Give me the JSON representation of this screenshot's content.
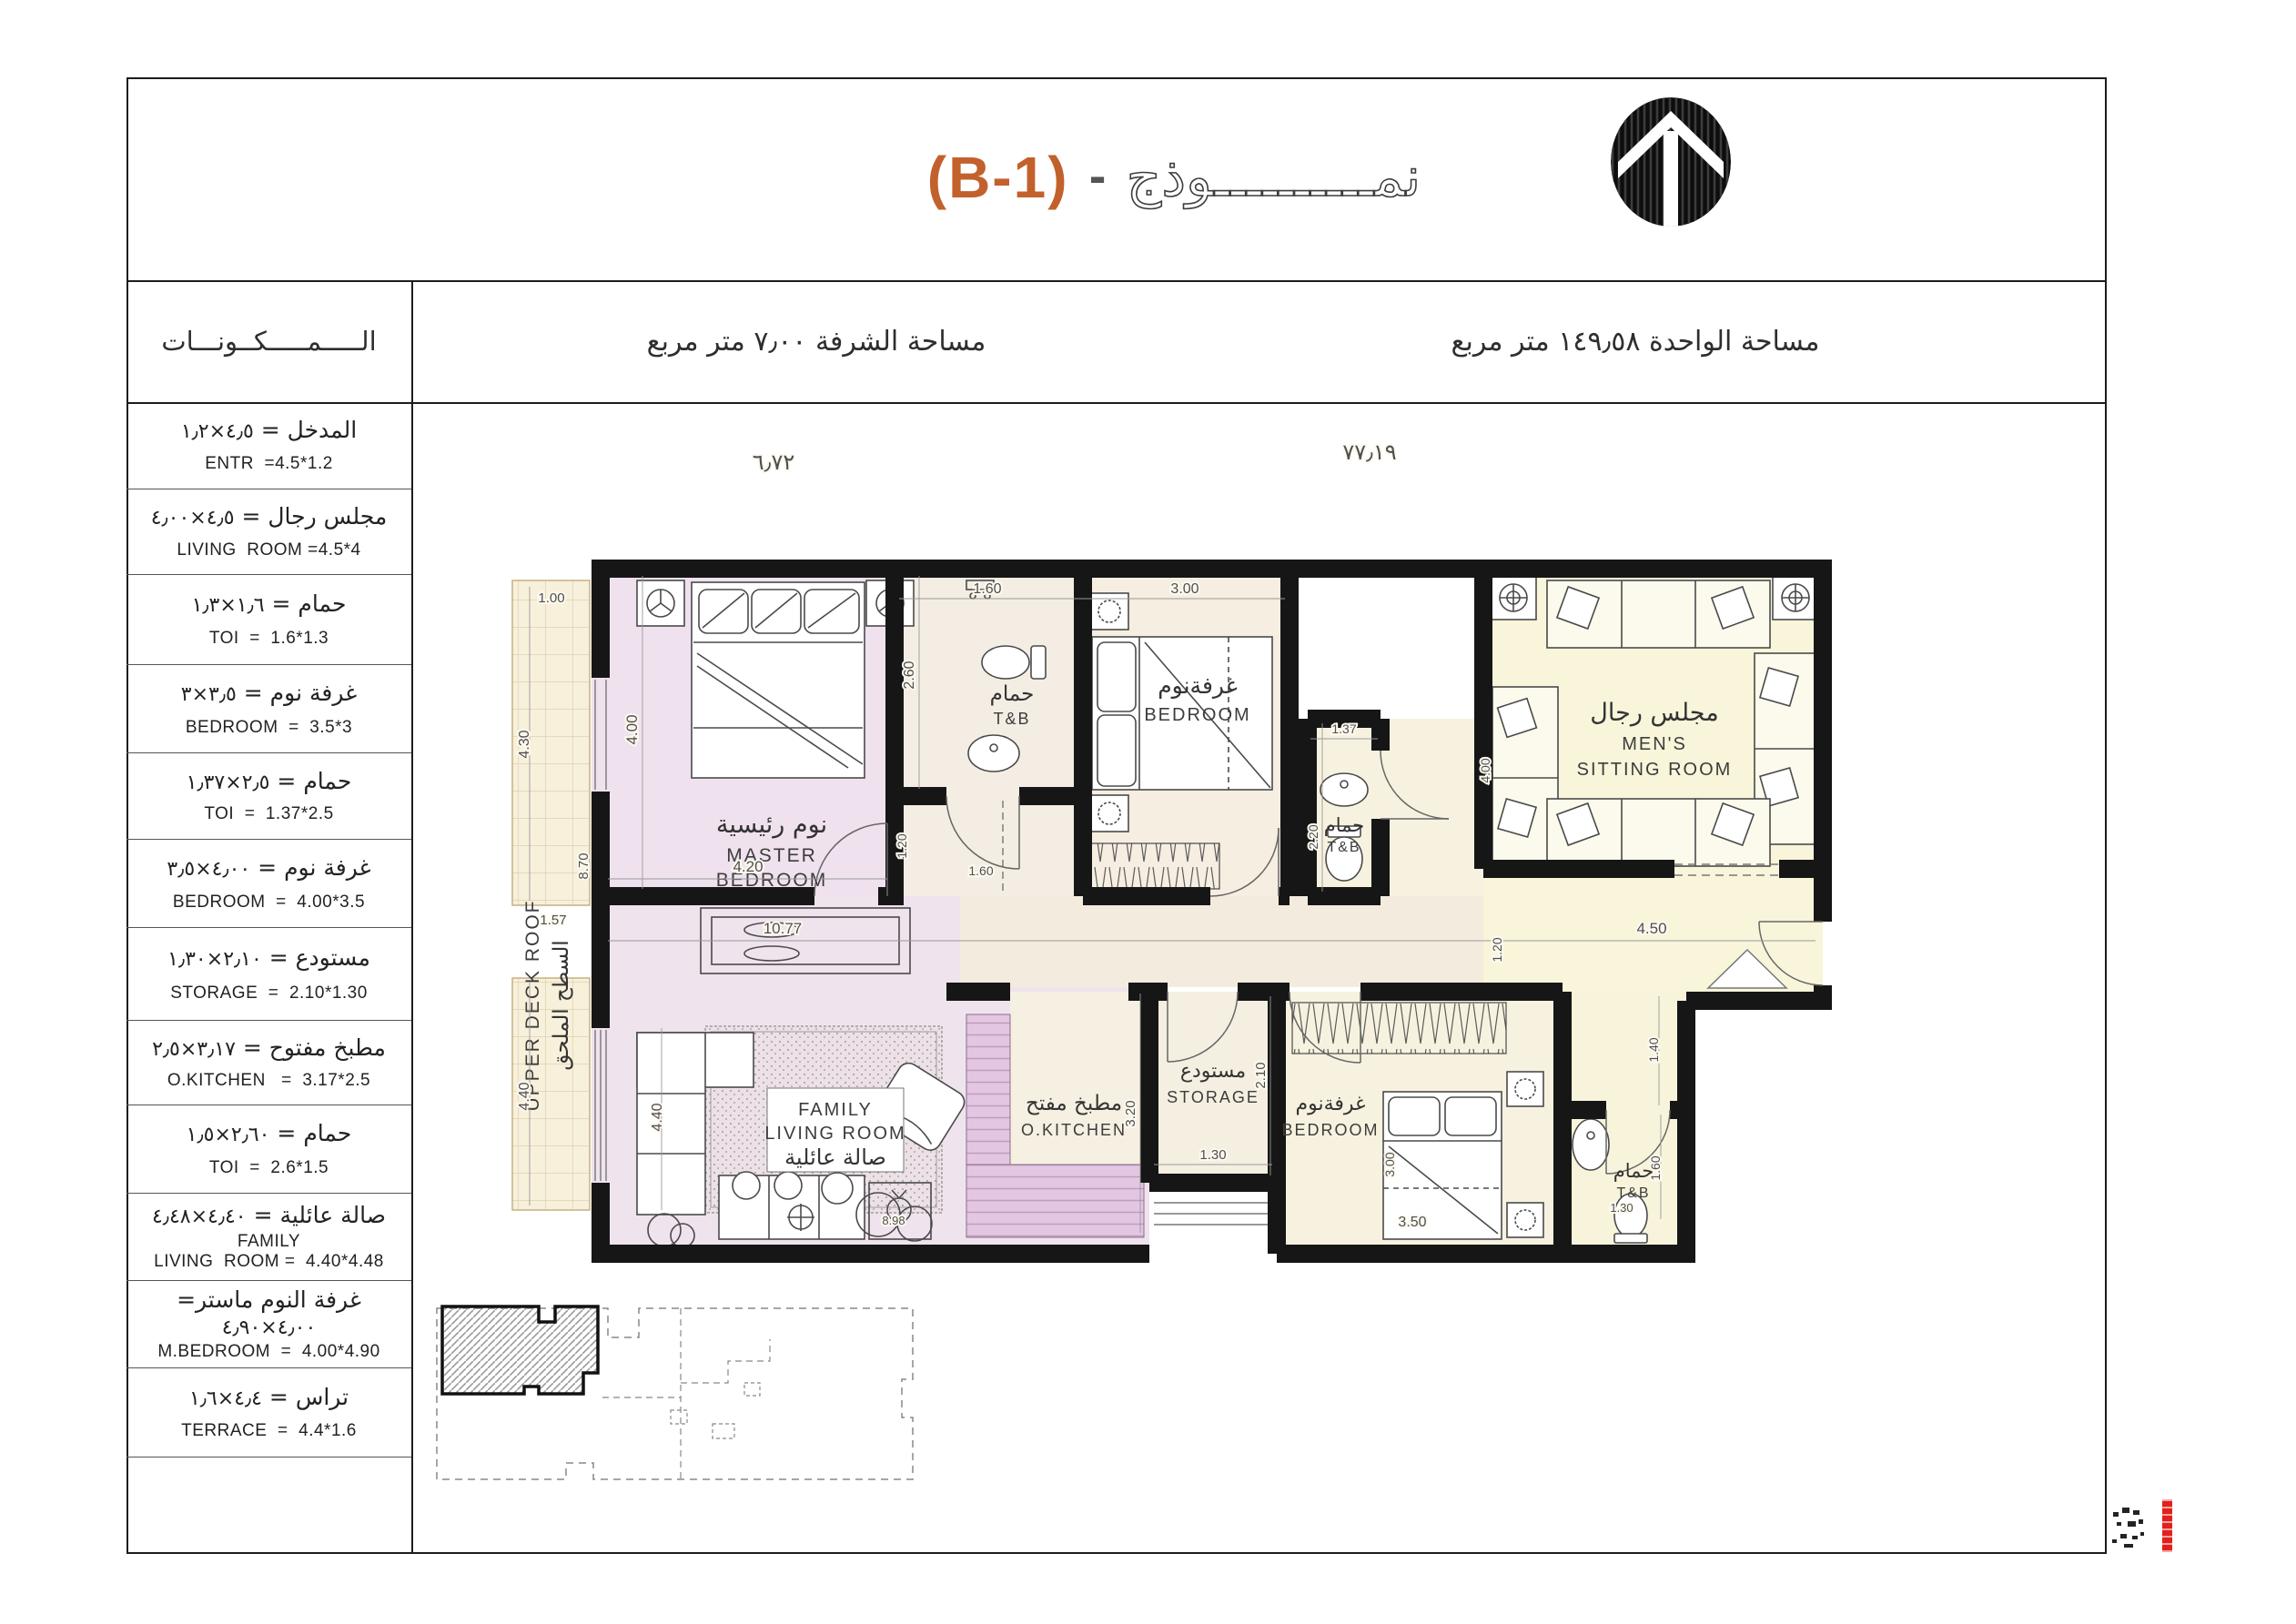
{
  "title": {
    "model_ar": "نمــــــــــوذج",
    "dash": "-",
    "code": "(B-1)"
  },
  "header": {
    "components": "الـــــمـــــكــونـــات",
    "balcony": "مساحة الشرفة  ٧٫٠٠  متر مربع",
    "unit": "مساحة الواحدة  ١٤٩٫٥٨  متر مربع"
  },
  "components": [
    {
      "ar": "المدخل =",
      "dims": "٤٫٥×١٫٢",
      "en": "ENTR  =4.5*1.2"
    },
    {
      "ar": "مجلس رجال  =",
      "dims": "٤٫٥×٤٫٠٠",
      "en": "LIVING  ROOM =4.5*4"
    },
    {
      "ar": "حمام =",
      "dims": "١٫٦×١٫٣",
      "en": "TOI  =  1.6*1.3"
    },
    {
      "ar": "غرفة نوم  =",
      "dims": "٣٫٥×٣",
      "en": "BEDROOM  =  3.5*3"
    },
    {
      "ar": "حمام =",
      "dims": "٢٫٥×١٫٣٧",
      "en": "TOI  =  1.37*2.5"
    },
    {
      "ar": "غرفة نوم =",
      "dims": "٤٫٠٠×٣٫٥",
      "en": "BEDROOM  =  4.00*3.5"
    },
    {
      "ar": "مستودع  =",
      "dims": "٢٫١٠×١٫٣٠",
      "en": "STORAGE  =  2.10*1.30"
    },
    {
      "ar": "مطبخ مفتوح =",
      "dims": "٣٫١٧×٢٫٥",
      "en": "O.KITCHEN   =  3.17*2.5"
    },
    {
      "ar": "حمام =",
      "dims": "٢٫٦٠×١٫٥",
      "en": "TOI  =  2.6*1.5"
    },
    {
      "ar": "صالة عائلية =",
      "dims": "٤٫٤٠×٤٫٤٨",
      "en": "FAMILY\nLIVING  ROOM =  4.40*4.48"
    },
    {
      "ar": "غرفة النوم ماستر=",
      "dims": "٤٫٠٠×٤٫٩٠",
      "en": "M.BEDROOM  =  4.00*4.90"
    },
    {
      "ar": "تراس =",
      "dims": "٤٫٤×١٫٦",
      "en": "TERRACE  =  4.4*1.6"
    }
  ],
  "plan": {
    "rooms": {
      "master": {
        "ar": "نوم رئيسية",
        "en1": "MASTER",
        "en2": "BEDROOM"
      },
      "tb": {
        "ar": "حمام",
        "en": "T&B"
      },
      "bedroom": {
        "ar": "غرفةنوم",
        "en": "BEDROOM"
      },
      "mens": {
        "ar": "مجلس رجال",
        "en1": "MEN'S",
        "en2": "SITTING  ROOM"
      },
      "family": {
        "en1": "FAMILY",
        "en2": "LIVING ROOM",
        "ar": "صالة عائلية"
      },
      "kitchen": {
        "ar": "مطبخ مفتح",
        "en": "O.KITCHEN"
      },
      "storage": {
        "ar": "مستودع",
        "en": "STORAGE"
      },
      "deck": {
        "en": "UPPER  DECK  ROOF",
        "ar": "السطح الملحق"
      }
    },
    "dims": {
      "top_left": "٦٫٧٢",
      "top_right": "٧٧٫١٩",
      "t100": "1.00",
      "t430": "4.30",
      "t870": "8.70",
      "t157": "1.57",
      "t440": "4.40",
      "m400": "4.00",
      "m420": "4.20",
      "b160": "1.60",
      "b260": "2.60",
      "b300": "3.00",
      "v120": "1.20",
      "v160": "1.60",
      "tb137": "1.37",
      "tb220": "2.20",
      "c1077": "10.77",
      "c450": "4.50",
      "e120": "1.20",
      "ms400": "4.00",
      "k320": "3.20",
      "s210": "2.10",
      "s130": "1.30",
      "b350": "3.50",
      "b3300": "3.00",
      "h140": "1.40",
      "t160": "1.60",
      "t130": "1.30",
      "f440": "4.40",
      "f898": "8.98"
    }
  },
  "colors": {
    "accent": "#C2612C",
    "wall": "#161616",
    "master_fill": "#EFE2EE",
    "beige_fill": "#F4EDE1",
    "yellow_fill": "#F8F5DA",
    "terrace_fill": "#F7F0DB",
    "counter_fill": "#E3C6E1",
    "stamp_red": "#E2201D"
  }
}
